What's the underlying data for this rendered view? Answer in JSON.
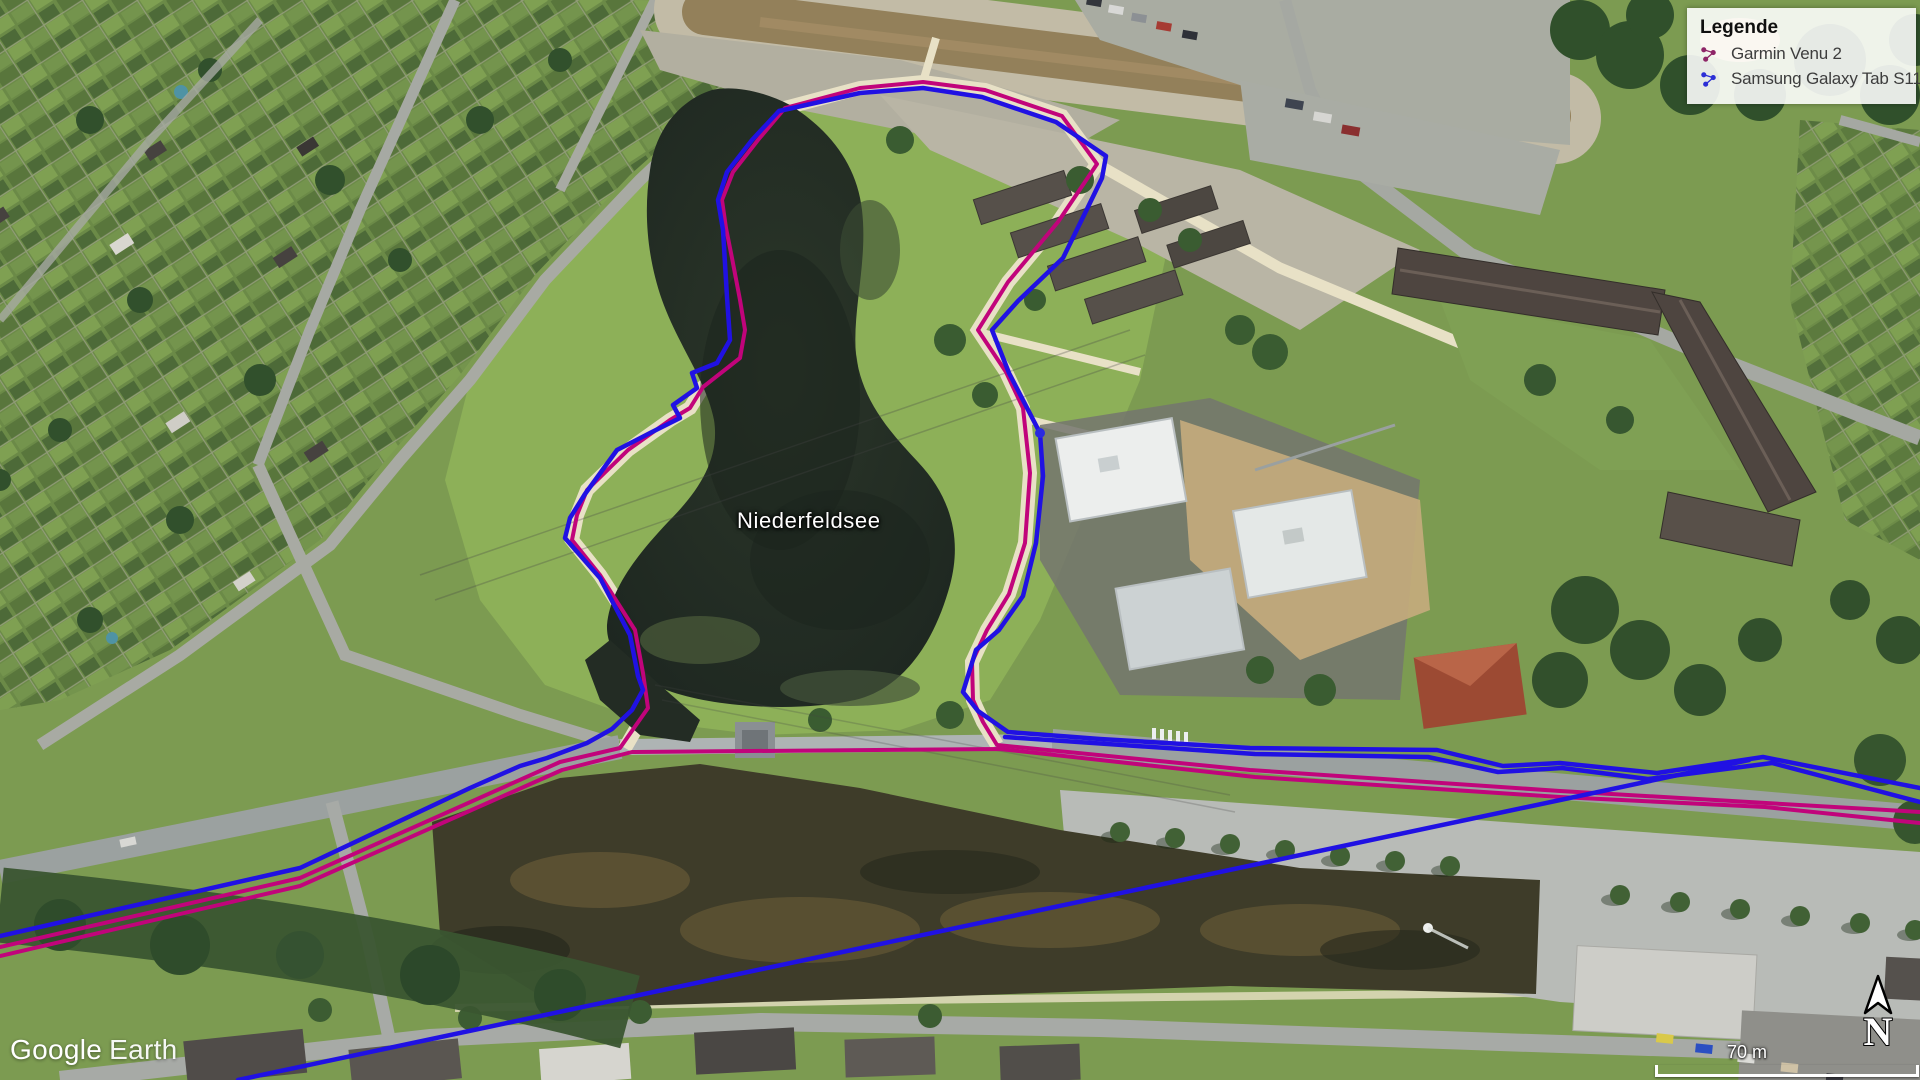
{
  "app": {
    "logo_google": "Google",
    "logo_earth": "Earth"
  },
  "map": {
    "place_label": "Niederfeldsee"
  },
  "legend": {
    "title": "Legende",
    "items": [
      {
        "label": "Garmin Venu 2",
        "color": "#8e2567",
        "track_color": "#c1047b"
      },
      {
        "label": "Samsung Galaxy Tab S11",
        "color": "#2c2fd6",
        "track_color": "#2011e3"
      }
    ]
  },
  "scale_bar": {
    "label": "70 m"
  },
  "compass": {
    "label": "N"
  }
}
